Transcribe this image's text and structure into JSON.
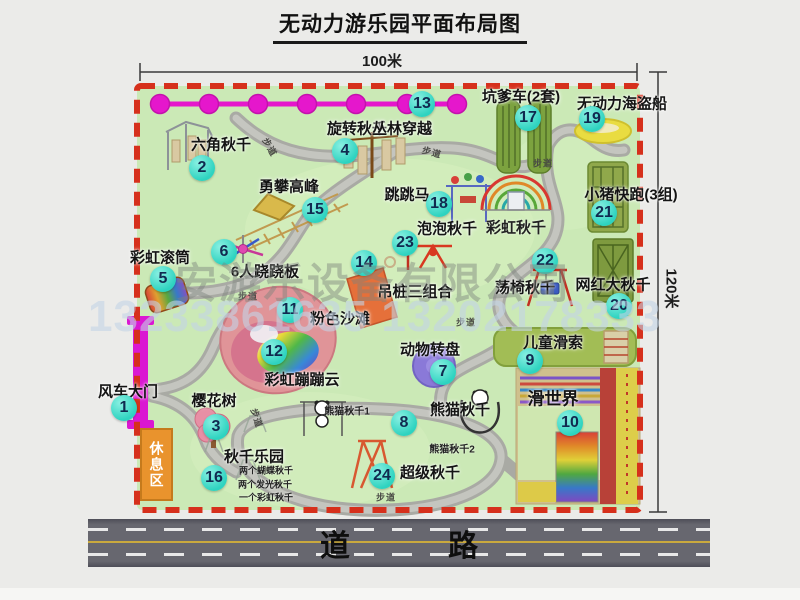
{
  "title": "无动力游乐园平面布局图",
  "dimensions": {
    "width": "100米",
    "height": "120米"
  },
  "road": {
    "label": "道　路"
  },
  "watermark": {
    "company": "安游乐设备有限公司",
    "phones": "13233861635 13202178333"
  },
  "rest_area": {
    "label": "休息区"
  },
  "attractions": [
    {
      "num": "1",
      "label": "风车大门",
      "lx": 128,
      "ly": 391,
      "bx": 124,
      "by": 408
    },
    {
      "num": "2",
      "label": "六角秋千",
      "lx": 221,
      "ly": 144,
      "bx": 202,
      "by": 168
    },
    {
      "num": "3",
      "label": "樱花树",
      "lx": 214,
      "ly": 400,
      "bx": 216,
      "by": 427
    },
    {
      "num": "4",
      "label": "旋转秋千",
      "lx": 357,
      "ly": 128,
      "bx": 345,
      "by": 151
    },
    {
      "num": "5",
      "label": "彩虹滚筒",
      "lx": 160,
      "ly": 257,
      "bx": 163,
      "by": 279
    },
    {
      "num": "6",
      "label": "6人跷跷板",
      "lx": 265,
      "ly": 271,
      "bx": 224,
      "by": 252
    },
    {
      "num": "7",
      "label": "动物转盘",
      "lx": 430,
      "ly": 349,
      "bx": 443,
      "by": 372
    },
    {
      "num": "8",
      "label": "熊猫秋千",
      "lx": 460,
      "ly": 409,
      "bx": 404,
      "by": 423
    },
    {
      "num": "9",
      "label": "儿童滑索",
      "lx": 553,
      "ly": 342,
      "bx": 530,
      "by": 361
    },
    {
      "num": "10",
      "label": "滑世界",
      "lx": 553,
      "ly": 397,
      "bx": 570,
      "by": 423,
      "fs": 17
    },
    {
      "num": "11",
      "label": "粉色沙滩",
      "lx": 340,
      "ly": 318,
      "bx": 290,
      "by": 310
    },
    {
      "num": "12",
      "label": "彩虹蹦蹦云",
      "lx": 302,
      "ly": 379,
      "bx": 274,
      "by": 352
    },
    {
      "num": "13",
      "label": "丛林穿越",
      "lx": 402,
      "ly": 128,
      "bx": 422,
      "by": 104
    },
    {
      "num": "14",
      "label": "吊桩三组合",
      "lx": 415,
      "ly": 291,
      "bx": 364,
      "by": 263
    },
    {
      "num": "15",
      "label": "勇攀高峰",
      "lx": 289,
      "ly": 186,
      "bx": 315,
      "by": 210
    },
    {
      "num": "16",
      "label": "秋千乐园",
      "lx": 254,
      "ly": 456,
      "bx": 214,
      "by": 478
    },
    {
      "num": "17",
      "label": "坑爹车(2套)",
      "lx": 521,
      "ly": 96,
      "bx": 528,
      "by": 118
    },
    {
      "num": "18",
      "label": "跳跳马",
      "lx": 407,
      "ly": 194,
      "bx": 439,
      "by": 204
    },
    {
      "num": "19",
      "label": "无动力海盗船",
      "lx": 622,
      "ly": 103,
      "bx": 592,
      "by": 119
    },
    {
      "num": "20",
      "label": "网红大秋千",
      "lx": 613,
      "ly": 284,
      "bx": 619,
      "by": 306
    },
    {
      "num": "21",
      "label": "小猪快跑(3组)",
      "lx": 631,
      "ly": 194,
      "bx": 604,
      "by": 213
    },
    {
      "num": "22",
      "label": "荡椅秋千",
      "lx": 525,
      "ly": 287,
      "bx": 545,
      "by": 261
    },
    {
      "num": "23",
      "label": "泡泡秋千",
      "lx": 447,
      "ly": 228,
      "bx": 405,
      "by": 243
    },
    {
      "num": "24",
      "label": "超级秋千",
      "lx": 430,
      "ly": 472,
      "bx": 382,
      "by": 476
    }
  ],
  "sub_labels": [
    {
      "text": "彩虹秋千",
      "x": 516,
      "y": 227,
      "size": 15
    },
    {
      "text": "熊猫秋千1",
      "x": 347,
      "y": 410,
      "size": 10
    },
    {
      "text": "熊猫秋千2",
      "x": 452,
      "y": 448,
      "size": 10
    },
    {
      "text": "两个蝴蝶秋千",
      "x": 266,
      "y": 470,
      "size": 9
    },
    {
      "text": "两个发光秋千",
      "x": 265,
      "y": 484,
      "size": 9
    },
    {
      "text": "一个彩虹秋千",
      "x": 266,
      "y": 497,
      "size": 9
    }
  ],
  "path_labels": [
    {
      "text": "步道",
      "x": 270,
      "y": 147,
      "rot": 60
    },
    {
      "text": "步道",
      "x": 432,
      "y": 152,
      "rot": 15
    },
    {
      "text": "步道",
      "x": 543,
      "y": 163,
      "rot": 0
    },
    {
      "text": "步道",
      "x": 248,
      "y": 296,
      "rot": 0
    },
    {
      "text": "步道",
      "x": 466,
      "y": 322,
      "rot": 0
    },
    {
      "text": "步道",
      "x": 257,
      "y": 418,
      "rot": 72
    },
    {
      "text": "步道",
      "x": 386,
      "y": 497,
      "rot": 0
    }
  ]
}
